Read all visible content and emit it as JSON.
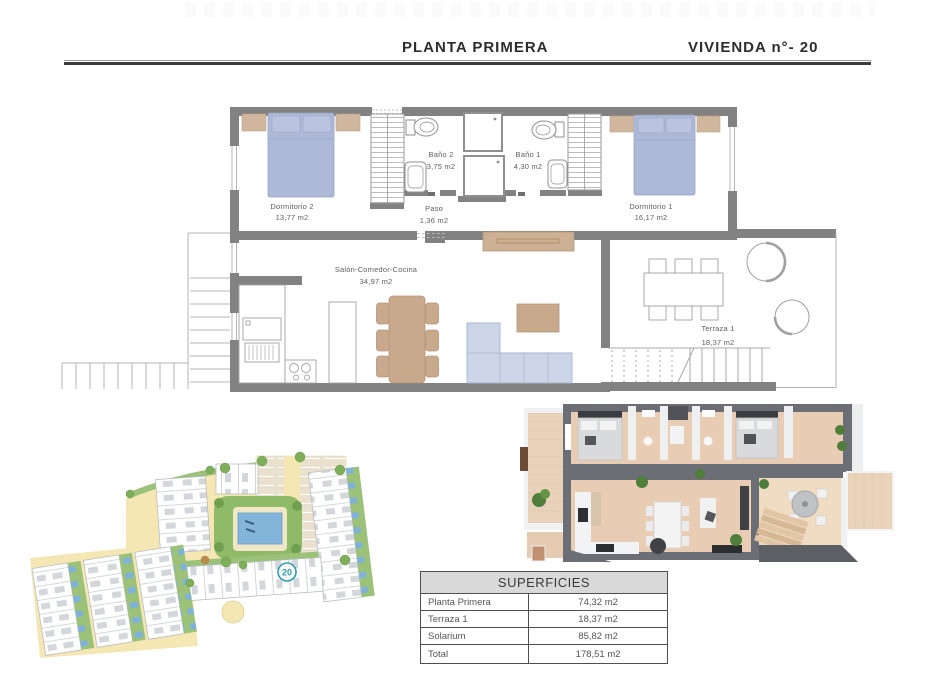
{
  "header": {
    "title_left": "PLANTA PRIMERA",
    "title_right": "VIVIENDA n°- 20"
  },
  "floor_plan": {
    "rooms": [
      {
        "name": "Dormitorio 2",
        "area": "13,77 m2"
      },
      {
        "name": "Baño 2",
        "area": "3,75 m2"
      },
      {
        "name": "Baño 1",
        "area": "4,30 m2"
      },
      {
        "name": "Paso",
        "area": "1,36 m2"
      },
      {
        "name": "Dormitorio 1",
        "area": "16,17 m2"
      },
      {
        "name": "Salón-Comedor-Cocina",
        "area": "34,97 m2"
      },
      {
        "name": "Terraza 1",
        "area": "18,37 m2"
      }
    ]
  },
  "site_plan": {
    "unit_badge": "20"
  },
  "surfaces_table": {
    "title": "SUPERFICIES",
    "rows": [
      {
        "label": "Planta Primera",
        "value": "74,32 m2"
      },
      {
        "label": "Terraza 1",
        "value": "18,37 m2"
      },
      {
        "label": "Solarium",
        "value": "85,82 m2"
      },
      {
        "label": "Total",
        "value": "178,51 m2"
      }
    ]
  },
  "colors": {
    "wall_gray": "#828282",
    "bed_blue": "#aeb9d7",
    "wood_tan": "#c8a98c",
    "sofa_blue": "#ccd4e7",
    "site_road_yellow": "#f4e7b4",
    "site_green": "#9cc178",
    "pool_blue": "#83b5da",
    "badge_teal": "#2f9db0",
    "render_wall": "#6b6e74",
    "render_floor": "#e8ccb3",
    "table_header_bg": "#d9d9d9"
  }
}
